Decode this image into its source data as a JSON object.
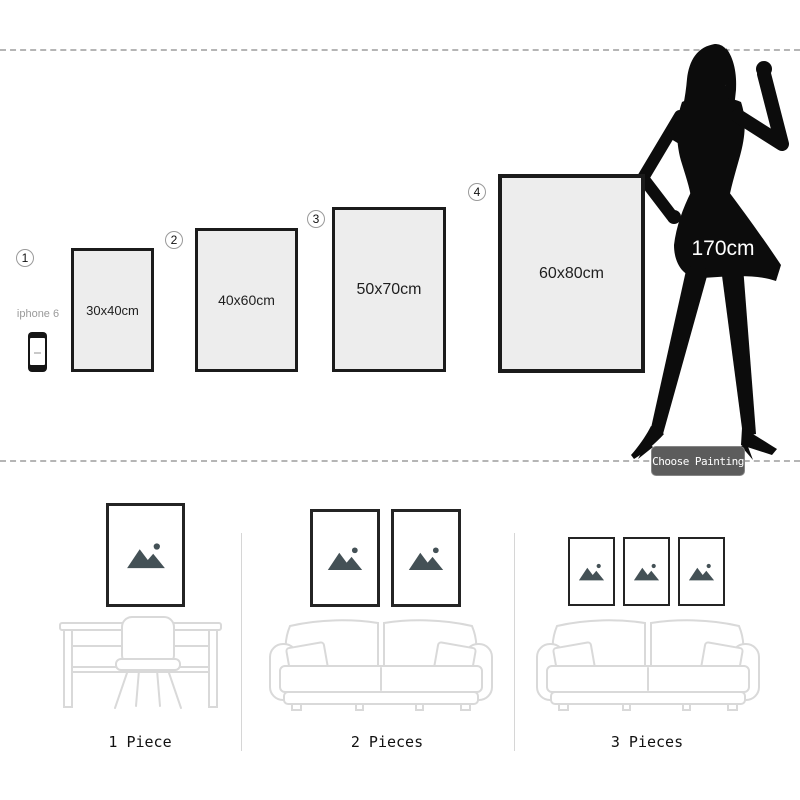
{
  "size_chart": {
    "frames": [
      {
        "number": "1",
        "size": "30x40cm"
      },
      {
        "number": "2",
        "size": "40x60cm"
      },
      {
        "number": "3",
        "size": "50x70cm"
      },
      {
        "number": "4",
        "size": "60x80cm"
      }
    ],
    "reference_phone": {
      "label": "iphone 6"
    },
    "reference_person": {
      "height_label": "170cm"
    },
    "button_label": "Choose Painting"
  },
  "piece_options": [
    {
      "label": "1 Piece"
    },
    {
      "label": "2 Pieces"
    },
    {
      "label": "3 Pieces"
    }
  ],
  "colors": {
    "frame_fill": "#ededed",
    "frame_border": "#1b1b1b",
    "wall_frame_border": "#242424",
    "icon_color": "#445156",
    "line_art": "#d9d9d9",
    "divider": "#d6d6d6",
    "dash": "#b5b5b5",
    "silhouette": "#0c0c0c",
    "button_bg": "#5c5c5c",
    "button_border": "#858585",
    "muted_text": "#9a9a9a",
    "text": "#1f1f1f"
  }
}
